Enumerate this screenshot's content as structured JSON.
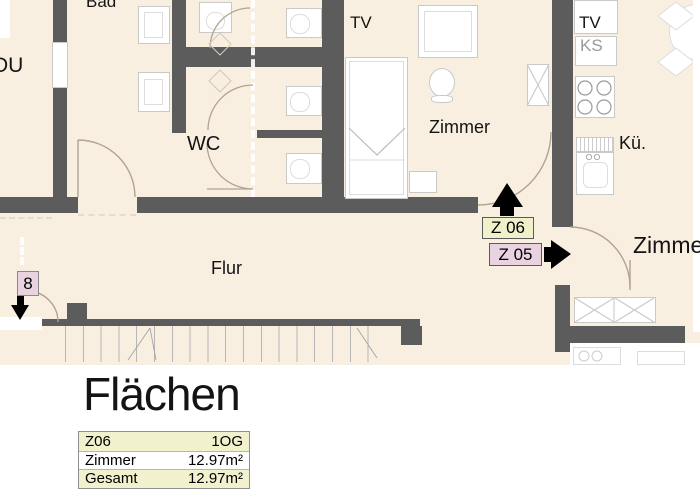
{
  "plan": {
    "rooms": {
      "bad": "Bad",
      "du": "DU",
      "wc": "WC",
      "tv_center": "TV",
      "zimmer_center": "Zimmer",
      "tv_kitchen": "TV",
      "ks": "KS",
      "kueche": "Kü.",
      "zimmer_right": "Zimmer",
      "flur": "Flur"
    },
    "badges": {
      "z06": "Z 06",
      "z05": "Z 05",
      "z08": "8"
    },
    "colors": {
      "floor": "#f9efe1",
      "wall": "#5c5c5c",
      "badge_yellow": "#f0f0ca",
      "badge_pink": "#e9d3e1",
      "arrow": "#000000",
      "ks_text": "#9a9a9a"
    }
  },
  "flaechen": {
    "title": "Flächen",
    "table": {
      "rows": [
        {
          "name": "Z06",
          "value": "1OG"
        },
        {
          "name": "Zimmer",
          "value": "12.97m²"
        },
        {
          "name": "Gesamt",
          "value": "12.97m²"
        }
      ]
    }
  }
}
